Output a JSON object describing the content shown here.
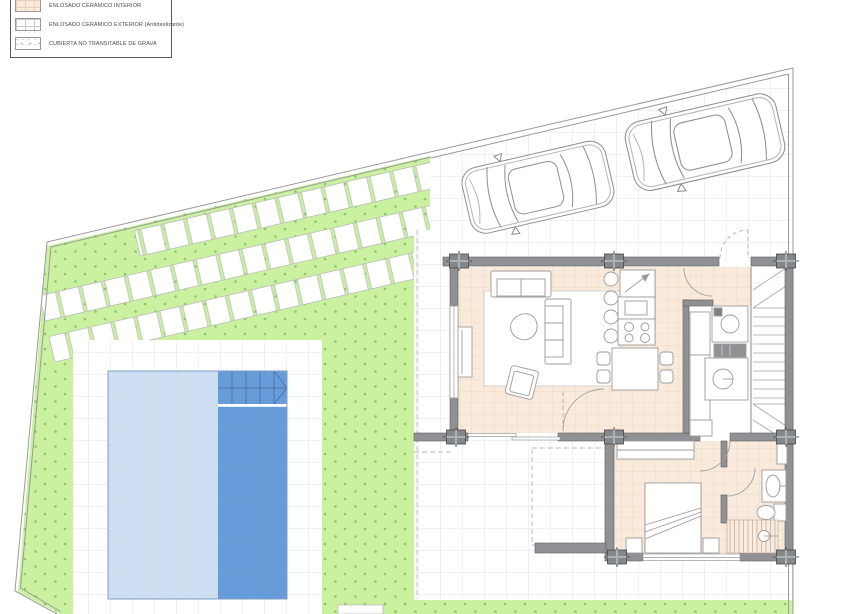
{
  "legend": {
    "items": [
      {
        "label": "ENLOSADO CERÁMICO INTERIOR",
        "swatch": "ceramic-interior-tile"
      },
      {
        "label": "ENLOSADO CERÁMICO EXTERIOR (Antideslizante)",
        "swatch": "ceramic-exterior-tile"
      },
      {
        "label": "CUBIERTA NO TRANSITABLE DE GRAVA",
        "swatch": "gravel-roof"
      }
    ]
  },
  "colors": {
    "grass": "#c9f1a0",
    "grass_dot": "#8cc767",
    "interior_floor": "#faeadb",
    "interior_grid": "#ecd5c0",
    "exterior_grid": "#d8d8d8",
    "wall": "#8f9194",
    "pool_shallow": "#cfdff2",
    "pool_deep": "#699dd9",
    "boundary_line": "#9a9a9a"
  }
}
